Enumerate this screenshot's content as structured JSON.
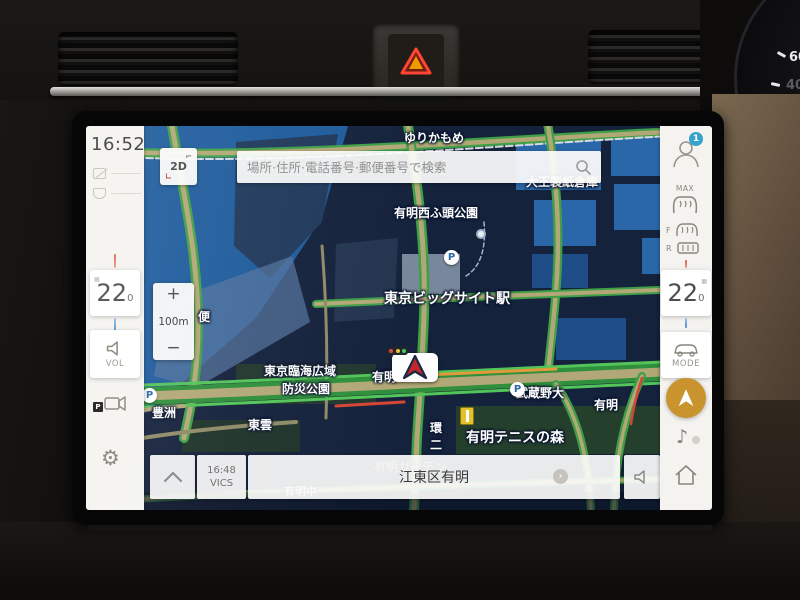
{
  "colors": {
    "map_bg": "#15223c",
    "water": "#1f5c9c",
    "building": "#2a67a8",
    "building_dark": "#1d4c86",
    "park": "#24402c",
    "road": "#b2a877",
    "traffic_green": "#43ad4b",
    "traffic_orange": "#e09a3c",
    "traffic_red": "#d64535",
    "rail": "#d5dbe0",
    "sidebar_bg": "#f4f3f0",
    "accent_orange": "#c9942e",
    "badge_blue": "#35a3cc",
    "marker_red": "#c1272d",
    "hazard_red": "#e03c2d"
  },
  "device": {
    "cluster_gauge": {
      "tick_60": "60",
      "tick_40": "40",
      "tick_20": "20",
      "unit": "°C"
    }
  },
  "screen": {
    "left_sidebar": {
      "time": "16:52",
      "temp_value": "22",
      "temp_decimal": "0",
      "volume_label": "VOL",
      "parking_label": "P"
    },
    "right_sidebar": {
      "profile_badge": "1",
      "max_label": "MAX",
      "front_label": "F",
      "rear_label": "R",
      "temp_value": "22",
      "temp_decimal": "0",
      "mode_label": "MODE"
    },
    "search": {
      "placeholder": "場所·住所·電話番号·郵便番号で検索"
    },
    "view_button": {
      "label": "2D"
    },
    "zoom_control": {
      "zoom_in": "+",
      "scale": "100m",
      "zoom_out": "−"
    },
    "bottom_bar": {
      "vics_time": "16:48",
      "vics_label": "VICS",
      "location": "江東区有明",
      "chevron": "›"
    },
    "map": {
      "labels": [
        {
          "t": "ゆりかもめ",
          "x": 318,
          "y": 3,
          "cls": "lbl"
        },
        {
          "t": "大王製紙倉庫",
          "x": 440,
          "y": 47,
          "cls": "lbl"
        },
        {
          "t": "有明西ふ頭公園",
          "x": 308,
          "y": 78,
          "cls": "lbl"
        },
        {
          "t": "東京ビッグサイト駅",
          "x": 298,
          "y": 162,
          "cls": "lbl-lg"
        },
        {
          "t": "東京臨海広域",
          "x": 178,
          "y": 236,
          "cls": "lbl"
        },
        {
          "t": "防災公園",
          "x": 196,
          "y": 254,
          "cls": "lbl"
        },
        {
          "t": "有明",
          "x": 286,
          "y": 242,
          "cls": "lbl"
        },
        {
          "t": "武蔵野大",
          "x": 430,
          "y": 258,
          "cls": "lbl"
        },
        {
          "t": "有明",
          "x": 508,
          "y": 270,
          "cls": "lbl"
        },
        {
          "t": "東雲",
          "x": 162,
          "y": 290,
          "cls": "lbl"
        },
        {
          "t": "豊洲",
          "x": 66,
          "y": 278,
          "cls": "lbl"
        },
        {
          "t": "環",
          "x": 344,
          "y": 293,
          "cls": "lbl"
        },
        {
          "t": "二",
          "x": 344,
          "y": 310,
          "cls": "lbl"
        },
        {
          "t": "有明テニスの森",
          "x": 380,
          "y": 301,
          "cls": "lbl-lg"
        },
        {
          "t": "有明ガーデン",
          "x": 288,
          "y": 332,
          "cls": "lbl-faint"
        },
        {
          "t": "有明中",
          "x": 198,
          "y": 357,
          "cls": "lbl-sm"
        },
        {
          "t": "便",
          "x": 112,
          "y": 182,
          "cls": "lbl"
        }
      ],
      "pois": [
        {
          "glyph": "P",
          "x": 358,
          "y": 124
        },
        {
          "glyph": "P",
          "x": 56,
          "y": 262
        },
        {
          "glyph": "P",
          "x": 424,
          "y": 256
        }
      ]
    }
  }
}
